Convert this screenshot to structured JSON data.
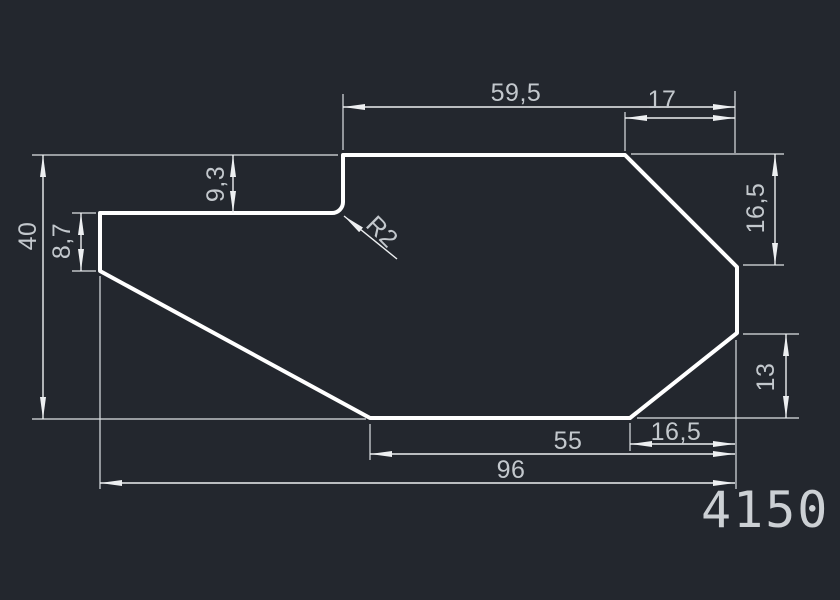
{
  "canvas": {
    "background_color": "#23272e",
    "outline_color": "#ffffff",
    "dimension_line_color": "#edeff1",
    "dimension_text_color": "#c3c8cd"
  },
  "part": {
    "number": "4150"
  },
  "dimensions": {
    "top_width": "59,5",
    "top_right_width": "17",
    "overall_height": "40",
    "step_depth": "9,3",
    "left_flange_height": "8,7",
    "corner_radius": "R2",
    "right_upper_height": "16,5",
    "right_lower_height": "13",
    "bottom_right_width": "16,5",
    "bottom_mid_width": "55",
    "bottom_overall_width": "96"
  }
}
